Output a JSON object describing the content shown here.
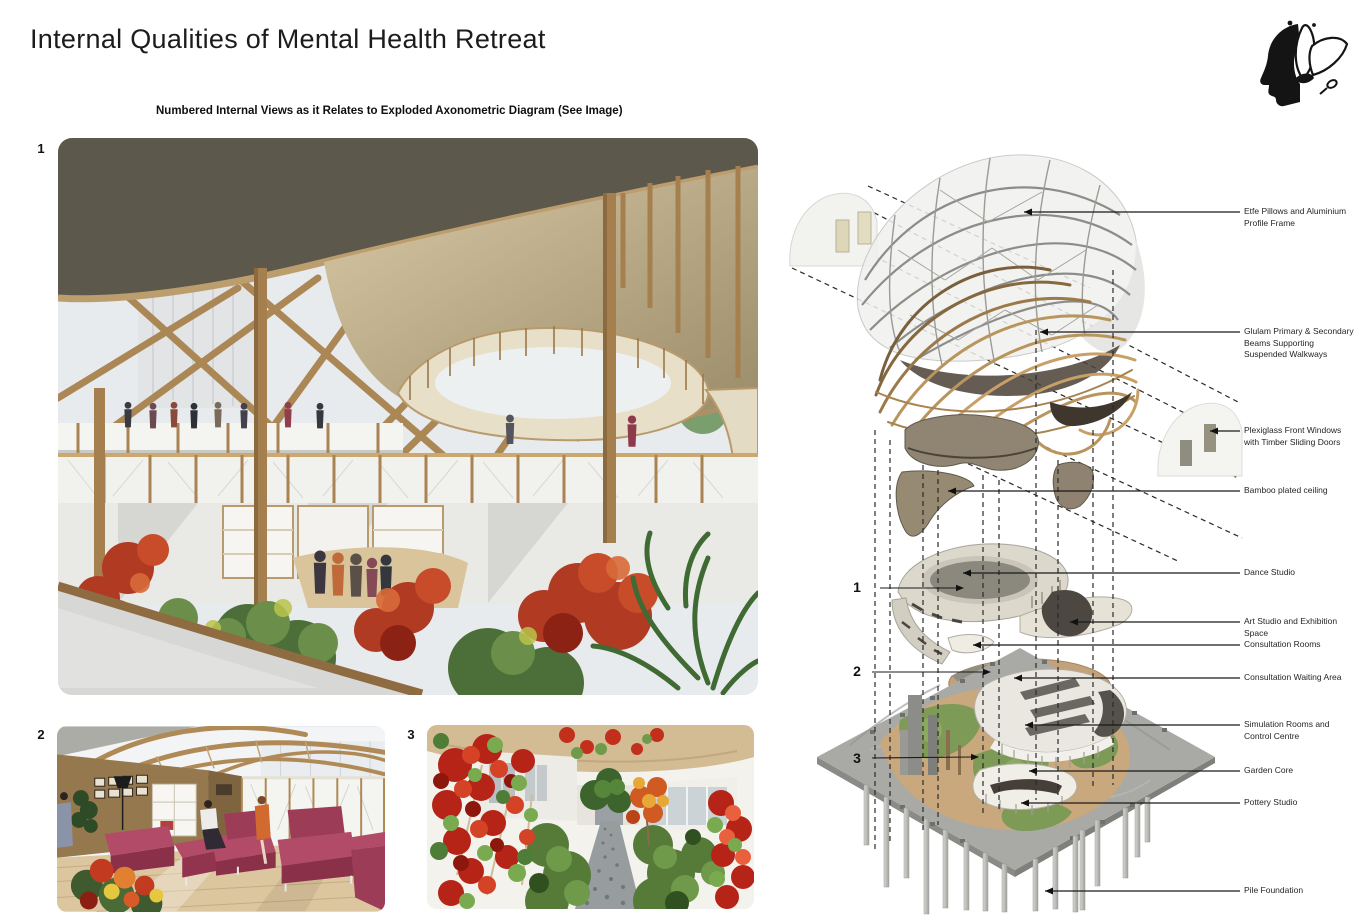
{
  "page": {
    "title": "Internal Qualities of Mental Health Retreat",
    "subtitle": "Numbered Internal Views as it Relates to Exploded Axonometric Diagram (See Image)"
  },
  "logo": {
    "name": "head-with-flower-logo"
  },
  "views": {
    "view1_number": "1",
    "view2_number": "2",
    "view3_number": "3",
    "view1_description": "atrium-walkway-render",
    "view2_description": "lounge-seating-render",
    "view3_description": "garden-path-render"
  },
  "diagram": {
    "number1": "1",
    "number2": "2",
    "number3": "3",
    "callouts": [
      {
        "label": "Etfe Pillows and Aluminium Profile Frame"
      },
      {
        "label": "Glulam Primary & Secondary Beams Supporting Suspended Walkways"
      },
      {
        "label": "Plexiglass Front Windows with Timber Sliding Doors"
      },
      {
        "label": "Bamboo plated ceiling"
      },
      {
        "label": "Dance Studio"
      },
      {
        "label": "Art Studio and Exhibition Space"
      },
      {
        "label": "Consultation Rooms"
      },
      {
        "label": "Consultation Waiting Area"
      },
      {
        "label": "Simulation Rooms and Control Centre"
      },
      {
        "label": "Garden Core"
      },
      {
        "label": "Pottery Studio"
      },
      {
        "label": "Pile Foundation"
      }
    ]
  },
  "colors": {
    "timber": "#b08a56",
    "glulam_dark": "#6f5636",
    "steel_grid": "#8c8c88",
    "concrete": "#a9a9a5",
    "foliage_red": "#c0392b",
    "foliage_green": "#5f8742",
    "sofa_maroon": "#9d3c57",
    "ink": "#1a1a1a"
  }
}
